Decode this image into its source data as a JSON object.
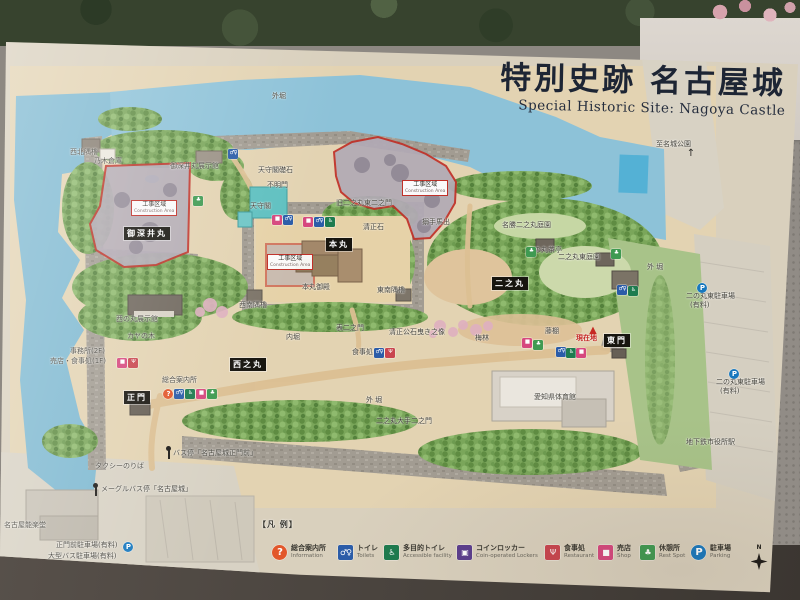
{
  "sign": {
    "title_jp": "特別史跡 名古屋城",
    "title_en": "Special Historic Site: Nagoya Castle"
  },
  "colors": {
    "construction_red": "#c03028",
    "current_location_red": "#c42420",
    "water": "#8dc2d8",
    "title": "#1d2534"
  },
  "legend": {
    "heading": "【凡 例】",
    "compass_label": "N",
    "items": [
      {
        "icon": "info",
        "jp": "総合案内所",
        "en": "Information",
        "x": 272
      },
      {
        "icon": "toilet",
        "jp": "トイレ",
        "en": "Toilets",
        "x": 338
      },
      {
        "icon": "accessible",
        "jp": "多目的トイレ",
        "en": "Accessible facility",
        "x": 384
      },
      {
        "icon": "locker",
        "jp": "コインロッカー",
        "en": "Coin-operated Lockers",
        "x": 457
      },
      {
        "icon": "restaurant",
        "jp": "食事処",
        "en": "Restaurant",
        "x": 545
      },
      {
        "icon": "shop",
        "jp": "売店",
        "en": "Shop",
        "x": 598
      },
      {
        "icon": "rest",
        "jp": "休憩所",
        "en": "Rest Spot",
        "x": 640
      },
      {
        "icon": "parking",
        "jp": "駐車場",
        "en": "Parking",
        "x": 691
      }
    ]
  },
  "icon_styles": {
    "info": {
      "glyph": "?",
      "color": "#e2572b",
      "shape": "circle"
    },
    "toilet": {
      "glyph": "♂♀",
      "color": "#2b5ca8",
      "shape": "square"
    },
    "accessible": {
      "glyph": "♿",
      "color": "#1e7b4f",
      "shape": "square"
    },
    "locker": {
      "glyph": "▣",
      "color": "#5b3e8e",
      "shape": "square"
    },
    "restaurant": {
      "glyph": "Ψ",
      "color": "#c9454f",
      "shape": "square"
    },
    "shop": {
      "glyph": "■",
      "color": "#d6487e",
      "shape": "square"
    },
    "rest": {
      "glyph": "♣",
      "color": "#3f9a52",
      "shape": "square"
    },
    "parking": {
      "glyph": "P",
      "color": "#1878be",
      "shape": "circle"
    },
    "triangle": {
      "glyph": "▲",
      "color": "#c62822",
      "shape": "plain"
    },
    "arrow": {
      "glyph": "↑",
      "color": "#2a2a26",
      "shape": "plain"
    }
  },
  "map": {
    "area_labels": [
      {
        "t": "御深井丸",
        "x": 124,
        "y": 227
      },
      {
        "t": "本丸",
        "x": 326,
        "y": 238
      },
      {
        "t": "二之丸",
        "x": 492,
        "y": 277
      },
      {
        "t": "西之丸",
        "x": 230,
        "y": 358
      },
      {
        "t": "正門",
        "x": 124,
        "y": 391
      },
      {
        "t": "東門",
        "x": 604,
        "y": 334
      }
    ],
    "construction_zone_label": {
      "jp": "工事区域",
      "en": "Construction Area"
    },
    "construction_label_positions": [
      {
        "x": 131,
        "y": 200
      },
      {
        "x": 402,
        "y": 180
      },
      {
        "x": 267,
        "y": 254
      }
    ],
    "labels": [
      {
        "t": "外堀",
        "x": 272,
        "y": 93
      },
      {
        "t": "至名城公園",
        "x": 656,
        "y": 141
      },
      {
        "t": "西北隅櫓",
        "x": 70,
        "y": 149
      },
      {
        "t": "乃木倉庫",
        "x": 94,
        "y": 158
      },
      {
        "t": "御深井丸展示館",
        "x": 170,
        "y": 163
      },
      {
        "t": "天守閣礎石",
        "x": 258,
        "y": 167
      },
      {
        "t": "不明門",
        "x": 267,
        "y": 182
      },
      {
        "t": "天守閣",
        "x": 250,
        "y": 203
      },
      {
        "t": "旧二之丸東二之門",
        "x": 336,
        "y": 200
      },
      {
        "t": "清正石",
        "x": 363,
        "y": 224
      },
      {
        "t": "搦手馬出",
        "x": 422,
        "y": 219
      },
      {
        "t": "本丸御殿",
        "x": 302,
        "y": 284
      },
      {
        "t": "東南隅櫓",
        "x": 377,
        "y": 287
      },
      {
        "t": "西南隅櫓",
        "x": 239,
        "y": 302
      },
      {
        "t": "西の丸展示館",
        "x": 116,
        "y": 316
      },
      {
        "t": "カヤの木",
        "x": 127,
        "y": 333
      },
      {
        "t": "事務所(2F)",
        "x": 70,
        "y": 348
      },
      {
        "t": "売店・食事処(1F)",
        "x": 50,
        "y": 358
      },
      {
        "t": "総合案内所",
        "x": 162,
        "y": 377
      },
      {
        "t": "内堀",
        "x": 286,
        "y": 334
      },
      {
        "t": "表二之門",
        "x": 336,
        "y": 325
      },
      {
        "t": "食事処",
        "x": 352,
        "y": 349
      },
      {
        "t": "清正公石曳き之像",
        "x": 389,
        "y": 329
      },
      {
        "t": "梅林",
        "x": 475,
        "y": 335
      },
      {
        "t": "藤棚",
        "x": 545,
        "y": 328
      },
      {
        "t": "名勝二之丸庭園",
        "x": 502,
        "y": 222
      },
      {
        "t": "二の丸茶亭",
        "x": 527,
        "y": 247
      },
      {
        "t": "二之丸東庭園",
        "x": 558,
        "y": 254
      },
      {
        "t": "外 堀",
        "x": 647,
        "y": 264
      },
      {
        "t": "愛知県体育館",
        "x": 534,
        "y": 394
      },
      {
        "t": "外 堀",
        "x": 366,
        "y": 397
      },
      {
        "t": "二之丸大手二之門",
        "x": 376,
        "y": 418
      },
      {
        "t": "二の丸東駐車場",
        "x": 686,
        "y": 293
      },
      {
        "t": "(有料)",
        "x": 690,
        "y": 302
      },
      {
        "t": "二の丸東駐車場",
        "x": 716,
        "y": 379
      },
      {
        "t": "(有料)",
        "x": 720,
        "y": 388
      },
      {
        "t": "地下鉄市役所駅",
        "x": 686,
        "y": 439
      },
      {
        "t": "タクシーのりば",
        "x": 95,
        "y": 463
      },
      {
        "t": "バス停「名古屋城正門前」",
        "x": 173,
        "y": 450
      },
      {
        "t": "メーグルバス停「名古屋城」",
        "x": 101,
        "y": 486
      },
      {
        "t": "名古屋能楽堂",
        "x": 4,
        "y": 522
      },
      {
        "t": "正門前駐車場(有料)",
        "x": 56,
        "y": 542
      },
      {
        "t": "大型バス駐車場(有料)",
        "x": 48,
        "y": 553
      },
      {
        "t": "現在地",
        "x": 576,
        "y": 335,
        "c": "red"
      }
    ],
    "icons": [
      {
        "type": "toilet",
        "x": 228,
        "y": 149
      },
      {
        "type": "rest",
        "x": 193,
        "y": 196
      },
      {
        "type": "shop",
        "x": 272,
        "y": 215
      },
      {
        "type": "toilet",
        "x": 283,
        "y": 215
      },
      {
        "type": "shop",
        "x": 303,
        "y": 217
      },
      {
        "type": "toilet",
        "x": 314,
        "y": 217
      },
      {
        "type": "accessible",
        "x": 325,
        "y": 217
      },
      {
        "type": "rest",
        "x": 526,
        "y": 247
      },
      {
        "type": "rest",
        "x": 611,
        "y": 249
      },
      {
        "type": "toilet",
        "x": 617,
        "y": 285
      },
      {
        "type": "accessible",
        "x": 628,
        "y": 286
      },
      {
        "type": "shop",
        "x": 117,
        "y": 358
      },
      {
        "type": "restaurant",
        "x": 128,
        "y": 358
      },
      {
        "type": "info",
        "x": 163,
        "y": 389
      },
      {
        "type": "toilet",
        "x": 174,
        "y": 389
      },
      {
        "type": "accessible",
        "x": 185,
        "y": 389
      },
      {
        "type": "shop",
        "x": 196,
        "y": 389
      },
      {
        "type": "rest",
        "x": 207,
        "y": 389
      },
      {
        "type": "toilet",
        "x": 374,
        "y": 348
      },
      {
        "type": "restaurant",
        "x": 385,
        "y": 348
      },
      {
        "type": "shop",
        "x": 522,
        "y": 338
      },
      {
        "type": "rest",
        "x": 533,
        "y": 340
      },
      {
        "type": "toilet",
        "x": 556,
        "y": 347
      },
      {
        "type": "accessible",
        "x": 566,
        "y": 348
      },
      {
        "type": "shop",
        "x": 576,
        "y": 348
      },
      {
        "type": "parking",
        "x": 697,
        "y": 283
      },
      {
        "type": "parking",
        "x": 729,
        "y": 369
      },
      {
        "type": "parking",
        "x": 123,
        "y": 542
      },
      {
        "type": "bus",
        "x": 164,
        "y": 446
      },
      {
        "type": "bus",
        "x": 91,
        "y": 483
      },
      {
        "type": "triangle",
        "x": 588,
        "y": 326
      },
      {
        "type": "arrow",
        "x": 686,
        "y": 149
      }
    ]
  }
}
